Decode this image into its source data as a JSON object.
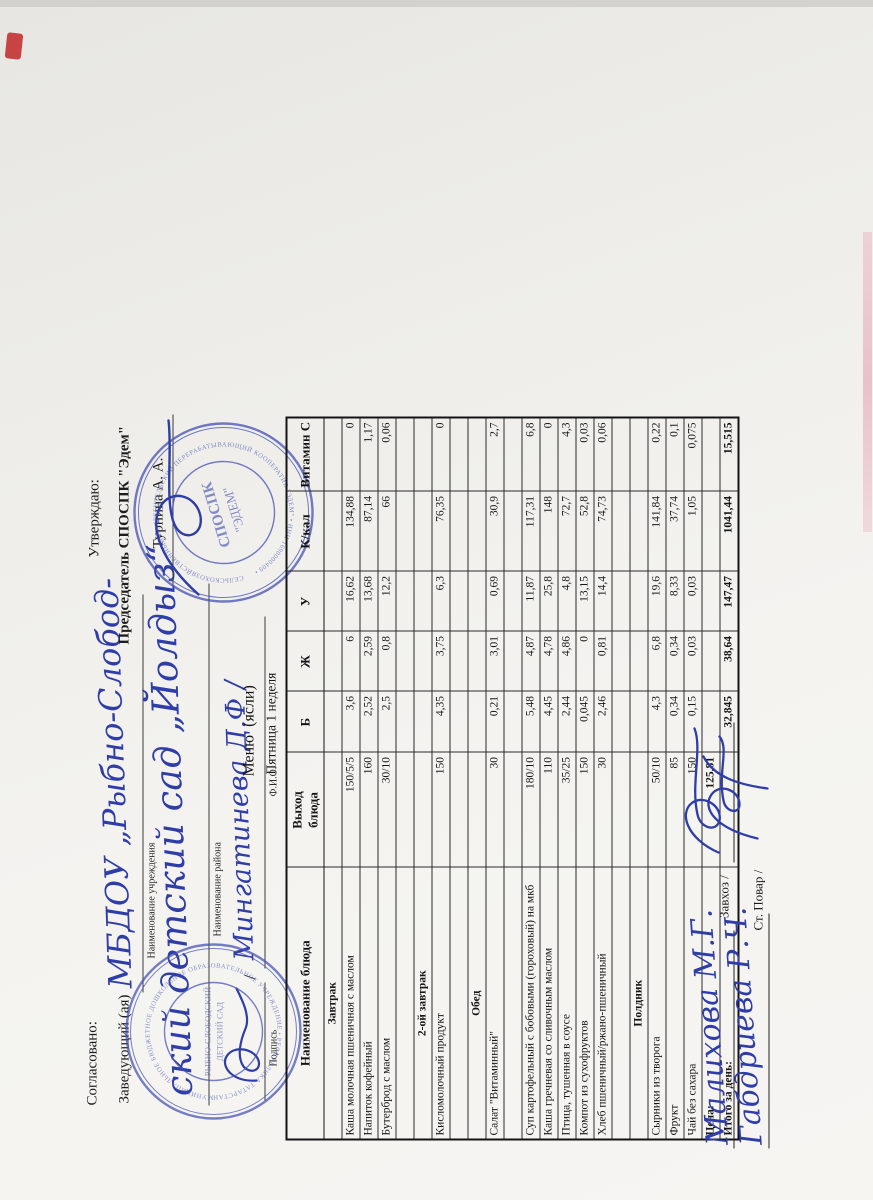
{
  "approval_left": {
    "label": "Согласовано:",
    "prefix": "Заведующий (ая)",
    "handwriting_line1": "МБДОУ „Рыбно-Слобод-",
    "caption_line1": "Наименование учреждения",
    "handwriting_line2": "ский детский сад „Йолдыз“",
    "caption_line2": "Наименование района",
    "slash": "/",
    "handwriting_name": "Мингатинева  Д.Ф /",
    "caption_sign": "Подпись",
    "caption_name": "Ф.И.О."
  },
  "approval_right": {
    "label": "Утверждаю:",
    "position_line": "Председатель СПОСПК \"Эдем\"",
    "name": "Турнина А. А."
  },
  "stamp_left": {
    "ring_text": "МУНИЦИПАЛЬНОЕ БЮДЖЕТНОЕ ДОШКОЛЬНОЕ ОБРАЗОВАТЕЛЬНОЕ УЧРЕЖДЕНИЕ • РЕСПУБЛИКА ТАТАРСТАН •",
    "center_line1": "РЫБНО-СЛОБОДСКИЙ",
    "center_line2": "ДЕТСКИЙ САД",
    "color": "#4450b2"
  },
  "stamp_right": {
    "ring_text": "СЕЛЬСКОХОЗЯЙСТВЕННЫЙ ПОТРЕБИТЕЛЬСКИЙ ПЕРЕРАБАТЫВАЮЩИЙ КООПЕРАТИВ \"ЭДЕМ\" • ИНН 1690000409 •",
    "center_line1": "СПОСПК",
    "center_line2": "\"ЭДЕМ\"",
    "color": "#4450b2"
  },
  "title": {
    "line1": "Меню  (ясли)",
    "line2": "Пятница 1 неделя"
  },
  "table": {
    "headers": [
      "Наименование блюда",
      "Выход\nблюда",
      "Б",
      "Ж",
      "У",
      "К/кал",
      "Витамин С"
    ],
    "rows": [
      {
        "type": "section",
        "name": "Завтрак"
      },
      {
        "type": "dish",
        "name": "Каша молочная пшеничная с маслом",
        "out": "150/5/5",
        "b": "3,6",
        "zh": "6",
        "u": "16,62",
        "kcal": "134,88",
        "vitc": "0"
      },
      {
        "type": "dish",
        "name": "Напиток кофейный",
        "out": "160",
        "b": "2,52",
        "zh": "2,59",
        "u": "13,68",
        "kcal": "87,14",
        "vitc": "1,17"
      },
      {
        "type": "dish",
        "name": "Бутерброд с маслом",
        "out": "30/10",
        "b": "2,5",
        "zh": "0,8",
        "u": "12,2",
        "kcal": "66",
        "vitc": "0,06"
      },
      {
        "type": "empty"
      },
      {
        "type": "section",
        "name": "2-ой завтрак"
      },
      {
        "type": "dish",
        "name": "Кисломолочный продукт",
        "out": "150",
        "b": "4,35",
        "zh": "3,75",
        "u": "6,3",
        "kcal": "76,35",
        "vitc": "0"
      },
      {
        "type": "empty"
      },
      {
        "type": "section",
        "name": "Обед"
      },
      {
        "type": "dish",
        "name": "Салат \"Витаминный\"",
        "out": "30",
        "b": "0,21",
        "zh": "3,01",
        "u": "0,69",
        "kcal": "30,9",
        "vitc": "2,7"
      },
      {
        "type": "empty"
      },
      {
        "type": "dish",
        "name": "Суп картофельный с бобовыми (гороховый) на мкб",
        "out": "180/10",
        "b": "5,48",
        "zh": "4,87",
        "u": "11,87",
        "kcal": "117,31",
        "vitc": "6,8"
      },
      {
        "type": "dish",
        "name": "Каша гречневая со сливочным маслом",
        "out": "110",
        "b": "4,45",
        "zh": "4,78",
        "u": "25,8",
        "kcal": "148",
        "vitc": "0"
      },
      {
        "type": "dish",
        "name": "Птица, тушенная в соусе",
        "out": "35/25",
        "b": "2,44",
        "zh": "4,86",
        "u": "4,8",
        "kcal": "72,7",
        "vitc": "4,3"
      },
      {
        "type": "dish",
        "name": "Компот из сухофруктов",
        "out": "150",
        "b": "0,045",
        "zh": "0",
        "u": "13,15",
        "kcal": "52,8",
        "vitc": "0,03"
      },
      {
        "type": "dish",
        "name": "Хлеб пшеничный/ржано-пшеничный",
        "out": "30",
        "b": "2,46",
        "zh": "0,81",
        "u": "14,4",
        "kcal": "74,73",
        "vitc": "0,06"
      },
      {
        "type": "empty"
      },
      {
        "type": "section",
        "name": "Полдник"
      },
      {
        "type": "dish",
        "name": "Сырники из творога",
        "out": "50/10",
        "b": "4,3",
        "zh": "6,8",
        "u": "19,6",
        "kcal": "141,84",
        "vitc": "0,22"
      },
      {
        "type": "dish",
        "name": "Фрукт",
        "out": "85",
        "b": "0,34",
        "zh": "0,34",
        "u": "8,33",
        "kcal": "37,74",
        "vitc": "0,1"
      },
      {
        "type": "dish",
        "name": "Чай без сахара",
        "out": "150",
        "b": "0,15",
        "zh": "0,03",
        "u": "0,03",
        "kcal": "1,05",
        "vitc": "0,075"
      },
      {
        "type": "total",
        "name": "Цена:",
        "out": "125,81"
      },
      {
        "type": "total",
        "name": "Итого за день:",
        "b": "32,845",
        "zh": "38,64",
        "u": "147,47",
        "kcal": "1041,44",
        "vitc": "15,515"
      }
    ]
  },
  "signatures": {
    "name1": "Малихова  М.Г.",
    "role1": ". Завхоз /",
    "name2": "Габдриева  Р.Ч.",
    "role2": "Ст. Повар /"
  }
}
